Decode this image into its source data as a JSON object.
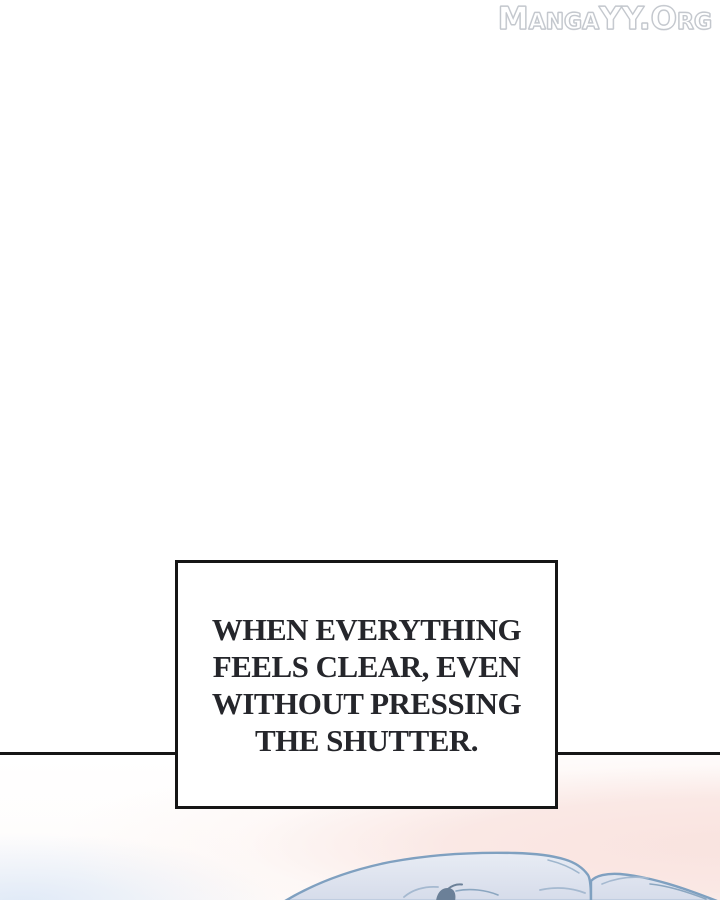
{
  "page": {
    "background_color": "#ffffff",
    "width": 720,
    "height": 900
  },
  "watermark": {
    "text": "MangaYY.Org",
    "fill_color": "#ffffff",
    "outline_color": "#c3c7cd"
  },
  "panel": {
    "divider_color": "#161616",
    "pink_color": "#f9e3df",
    "blue_tint_color": "#d6e4f6",
    "base_color": "#ffffff"
  },
  "speech_box": {
    "lines": [
      "WHEN EVERYTHING",
      "FEELS CLEAR, EVEN",
      "WITHOUT PRESSING",
      "THE SHUTTER."
    ],
    "background": "#ffffff",
    "border_color": "#151515",
    "text_color": "#25262b"
  },
  "illustration": {
    "description": "top of a character's head with light blue-gray hair entering from the bottom edge",
    "hair_fill_top": "#e8ecf4",
    "hair_fill_bottom": "#d6dcea",
    "hair_outline": "#7fa0c0",
    "strand_light": "#a5b9d0",
    "strand_mid": "#8ba6c0",
    "tuft_dark": "#6b8098"
  }
}
